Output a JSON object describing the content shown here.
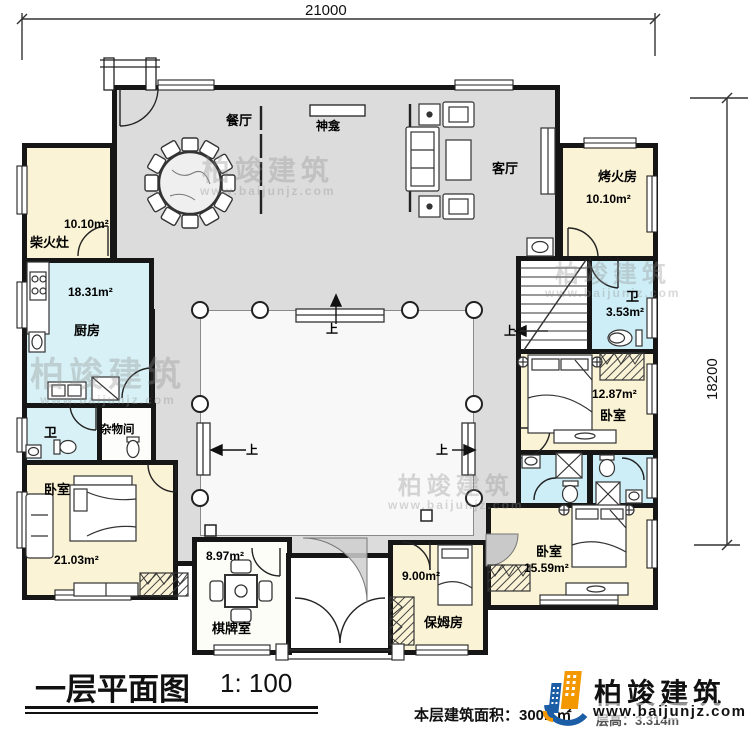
{
  "plan": {
    "dim_width": "21000",
    "dim_height": "18200",
    "up": "上",
    "title": "一层平面图",
    "scale": "1: 100",
    "area_note": "本层建筑面积：300.1㎡",
    "height_note": "层高：3.314m"
  },
  "rooms": {
    "dining": {
      "label": "餐厅"
    },
    "shrine": {
      "label": "神龛"
    },
    "living": {
      "label": "客厅"
    },
    "fire": {
      "label": "烤火房",
      "area": "10.10m²"
    },
    "stove": {
      "label": "柴火灶",
      "area": "10.10m²"
    },
    "kitchen": {
      "label": "厨房",
      "area": "18.31m²"
    },
    "wc_left": {
      "label": "卫"
    },
    "storage": {
      "label": "杂物间"
    },
    "bedroom_left": {
      "label": "卧室",
      "area": "21.03m²"
    },
    "wc_right": {
      "label": "卫",
      "area": "3.53m²"
    },
    "bedroom_mid": {
      "label": "卧室",
      "area": "12.87m²"
    },
    "bedroom_br": {
      "label": "卧室",
      "area": "15.59m²"
    },
    "chess": {
      "label": "棋牌室",
      "area": "8.97m²"
    },
    "nanny": {
      "label": "保姆房",
      "area": "9.00m²"
    }
  },
  "logo": {
    "name": "柏竣建筑",
    "url": "www.baijunjz.com"
  },
  "watermark": {
    "name": "柏竣建筑",
    "url": "www.baijunjz.com"
  },
  "colors": {
    "wall": "#161616",
    "corridor_floor": "#dcdcdc",
    "room_cream": "#fbf3d5",
    "room_cyan": "#d8f1f6",
    "bath_cyan": "#cdeef6",
    "logo_blue": "#1b5ea6",
    "logo_orange": "#f39800"
  }
}
